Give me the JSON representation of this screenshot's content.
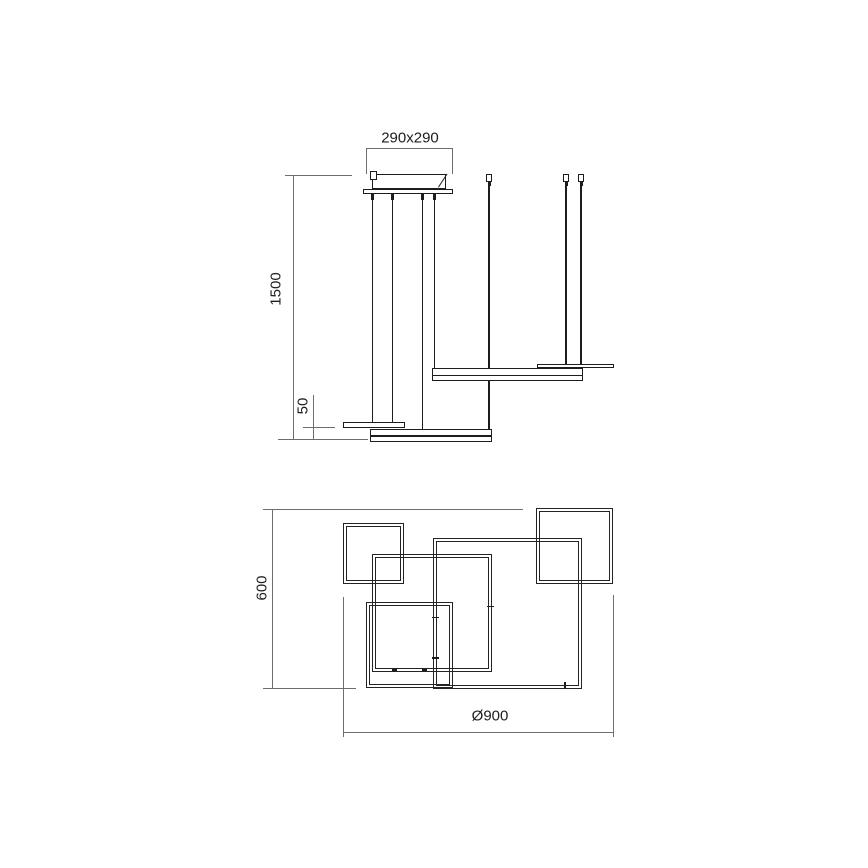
{
  "drawing": {
    "type": "technical-dimension-drawing",
    "subject": "square-frame pendant light — front elevation (top) and plan view (bottom)",
    "colors": {
      "outline": "#1d1d1b",
      "dimension_line": "#6e6e6e",
      "background": "#ffffff"
    },
    "side_view": {
      "dimensions": [
        {
          "id": "canopy-size",
          "label": "290x290"
        },
        {
          "id": "suspension-drop",
          "label": "1500"
        },
        {
          "id": "profile-height",
          "label": "50"
        }
      ]
    },
    "plan_view": {
      "dimensions": [
        {
          "id": "overall-depth",
          "label": "600"
        },
        {
          "id": "overall-width",
          "label": "Ø900"
        }
      ]
    }
  }
}
